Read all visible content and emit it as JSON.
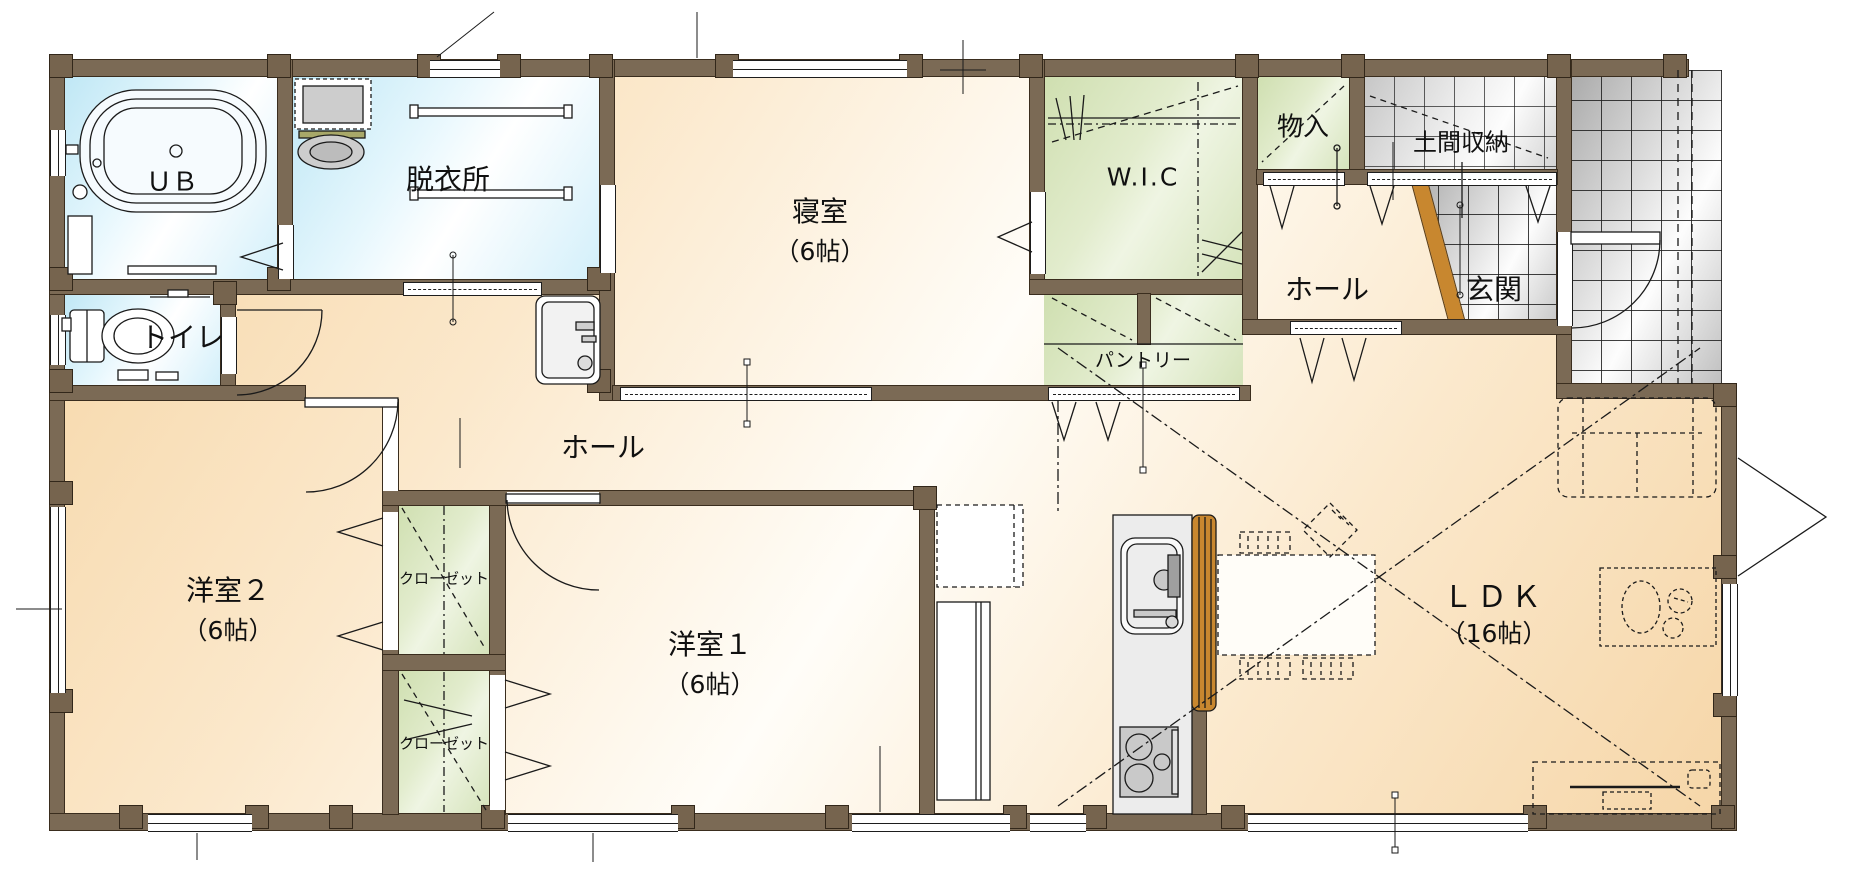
{
  "plan_type": "floor-plan-1f",
  "rooms": [
    {
      "id": "ub",
      "name": "ＵＢ"
    },
    {
      "id": "dressing",
      "name": "脱衣所"
    },
    {
      "id": "toilet",
      "name": "トイレ"
    },
    {
      "id": "bedroom",
      "name": "寝室",
      "size": "（6帖）"
    },
    {
      "id": "wic",
      "name": "W.I.C"
    },
    {
      "id": "storage",
      "name": "物入"
    },
    {
      "id": "doma",
      "name": "土間収納"
    },
    {
      "id": "hall-upper",
      "name": "ホール"
    },
    {
      "id": "genkan",
      "name": "玄関"
    },
    {
      "id": "pantry",
      "name": "パントリー"
    },
    {
      "id": "hall-lower",
      "name": "ホール"
    },
    {
      "id": "west-room-2",
      "name": "洋室２",
      "size": "（6帖）"
    },
    {
      "id": "closet-1",
      "name": "クローゼット"
    },
    {
      "id": "closet-2",
      "name": "クローゼット"
    },
    {
      "id": "west-room-1",
      "name": "洋室１",
      "size": "（6帖）"
    },
    {
      "id": "ldk",
      "name": "ＬＤＫ",
      "size": "（16帖）"
    }
  ],
  "fixtures": [
    "bathtub",
    "washing-machine",
    "laundry-sink",
    "towel-bar",
    "toilet-bowl",
    "washbasin",
    "kitchen-sink",
    "gas-stove",
    "kitchen-counter",
    "refrigerator",
    "cupboard",
    "dining-table",
    "dining-chair",
    "sofa",
    "coffee-table",
    "tv-board",
    "hanger-pipe"
  ],
  "colors": {
    "wall": "#7b6a55",
    "wood_floor": "#f6d6a8",
    "wet_floor": "#cfeef8",
    "storage_green": "#d5e3ba",
    "tile_gray": "#d9d9d9",
    "counter_wood": "#c8872f",
    "line": "#1a1a1a"
  }
}
